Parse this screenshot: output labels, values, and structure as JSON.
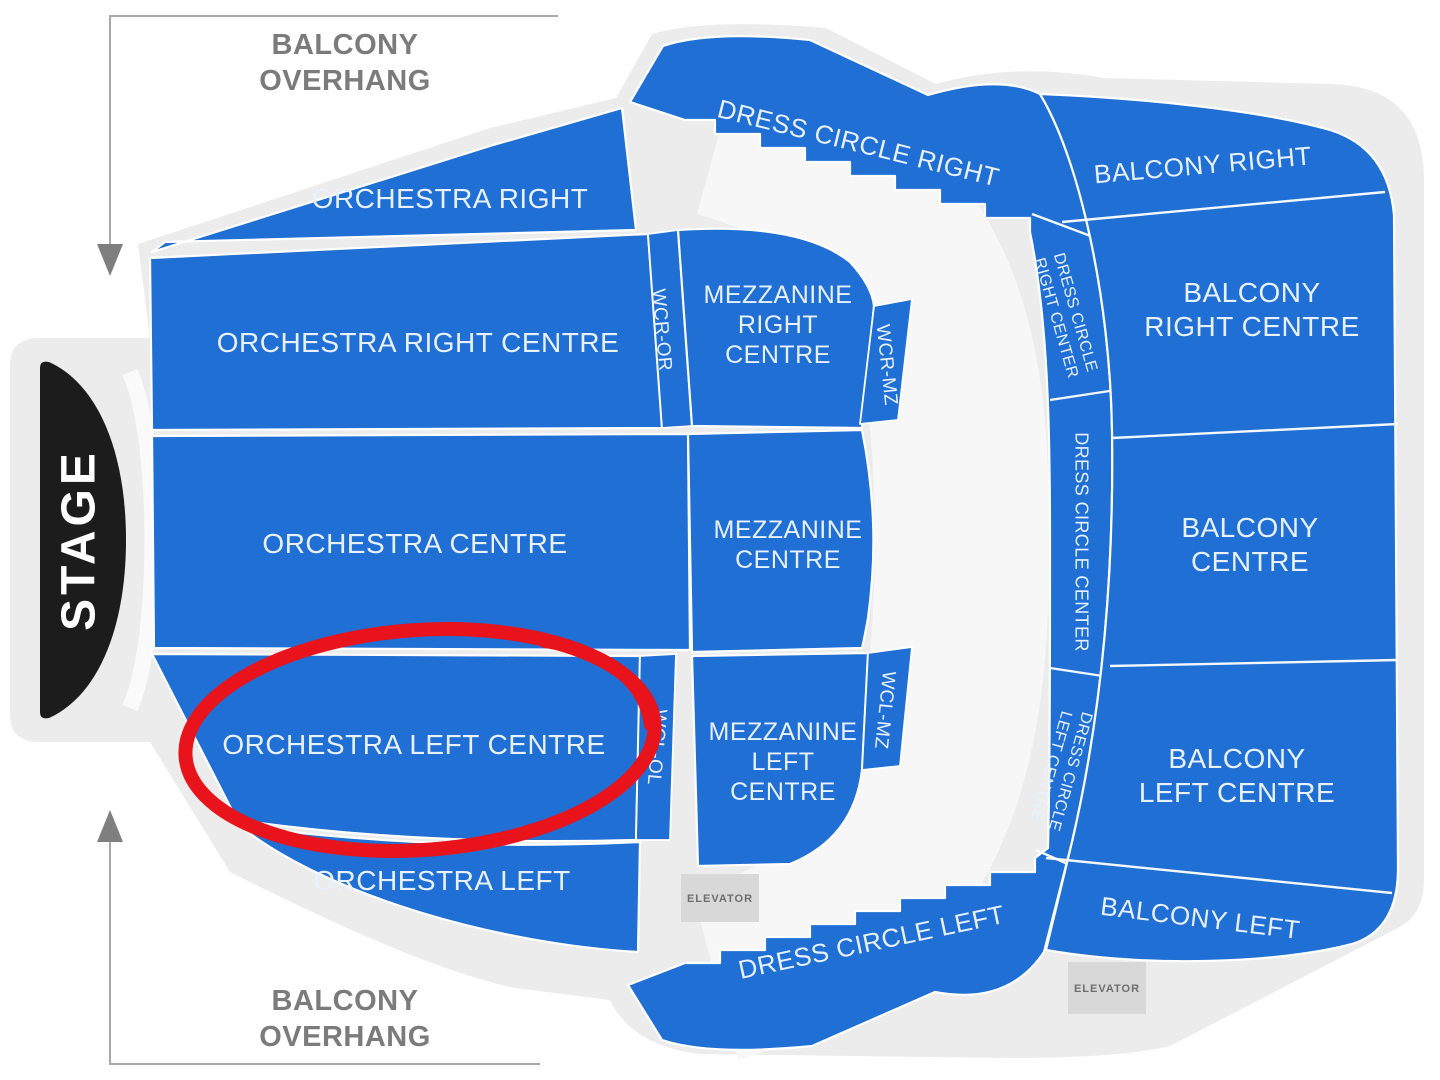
{
  "stage": {
    "label": "STAGE"
  },
  "overlays": {
    "balcony_overhang_top": {
      "line1": "BALCONY",
      "line2": "OVERHANG"
    },
    "balcony_overhang_bottom": {
      "line1": "BALCONY",
      "line2": "OVERHANG"
    }
  },
  "sections": {
    "orchestra_right": {
      "label": "ORCHESTRA RIGHT"
    },
    "orchestra_right_centre": {
      "label": "ORCHESTRA RIGHT CENTRE"
    },
    "orchestra_centre": {
      "label": "ORCHESTRA CENTRE"
    },
    "orchestra_left_centre": {
      "label": "ORCHESTRA LEFT CENTRE",
      "highlighted": true
    },
    "orchestra_left": {
      "label": "ORCHESTRA LEFT"
    },
    "wcr_or": {
      "label": "WCR-OR"
    },
    "wcl_ol": {
      "label": "WCL-OL"
    },
    "mezzanine_right_centre": {
      "lines": [
        "MEZZANINE",
        "RIGHT",
        "CENTRE"
      ]
    },
    "mezzanine_centre": {
      "lines": [
        "MEZZANINE",
        "CENTRE"
      ]
    },
    "mezzanine_left_centre": {
      "lines": [
        "MEZZANINE",
        "LEFT",
        "CENTRE"
      ]
    },
    "wcr_mz": {
      "label": "WCR-MZ"
    },
    "wcl_mz": {
      "label": "WCL-MZ"
    },
    "dress_circle_right": {
      "label": "DRESS CIRCLE RIGHT"
    },
    "dress_circle_right_center": {
      "lines": [
        "DRESS CIRCLE",
        "RIGHT CENTER"
      ]
    },
    "dress_circle_center": {
      "label": "DRESS CIRCLE CENTER"
    },
    "dress_circle_left_centre": {
      "lines": [
        "DRESS CIRCLE",
        "LEFT CENTRE"
      ]
    },
    "dress_circle_left": {
      "label": "DRESS CIRCLE LEFT"
    },
    "balcony_right": {
      "label": "BALCONY RIGHT"
    },
    "balcony_right_centre": {
      "lines": [
        "BALCONY",
        "RIGHT CENTRE"
      ]
    },
    "balcony_centre": {
      "lines": [
        "BALCONY",
        "CENTRE"
      ]
    },
    "balcony_left_centre": {
      "lines": [
        "BALCONY",
        "LEFT CENTRE"
      ]
    },
    "balcony_left": {
      "label": "BALCONY LEFT"
    }
  },
  "elevators": {
    "left_label": "ELEVATOR",
    "right_label": "ELEVATOR"
  },
  "annotation": {
    "shape": "hand-drawn-ellipse",
    "target_section": "ORCHESTRA LEFT CENTRE"
  },
  "colors": {
    "section_blue": "#1f6fd4",
    "footprint_gray": "#ececec",
    "aisle_white": "#f7f7f7",
    "stage_black": "#1c1c1c",
    "label_white": "#e8f1fd",
    "overhang_gray": "#7b7b7b",
    "elevator_gray": "#d8d8d8",
    "annotation_red": "#e8131b"
  }
}
